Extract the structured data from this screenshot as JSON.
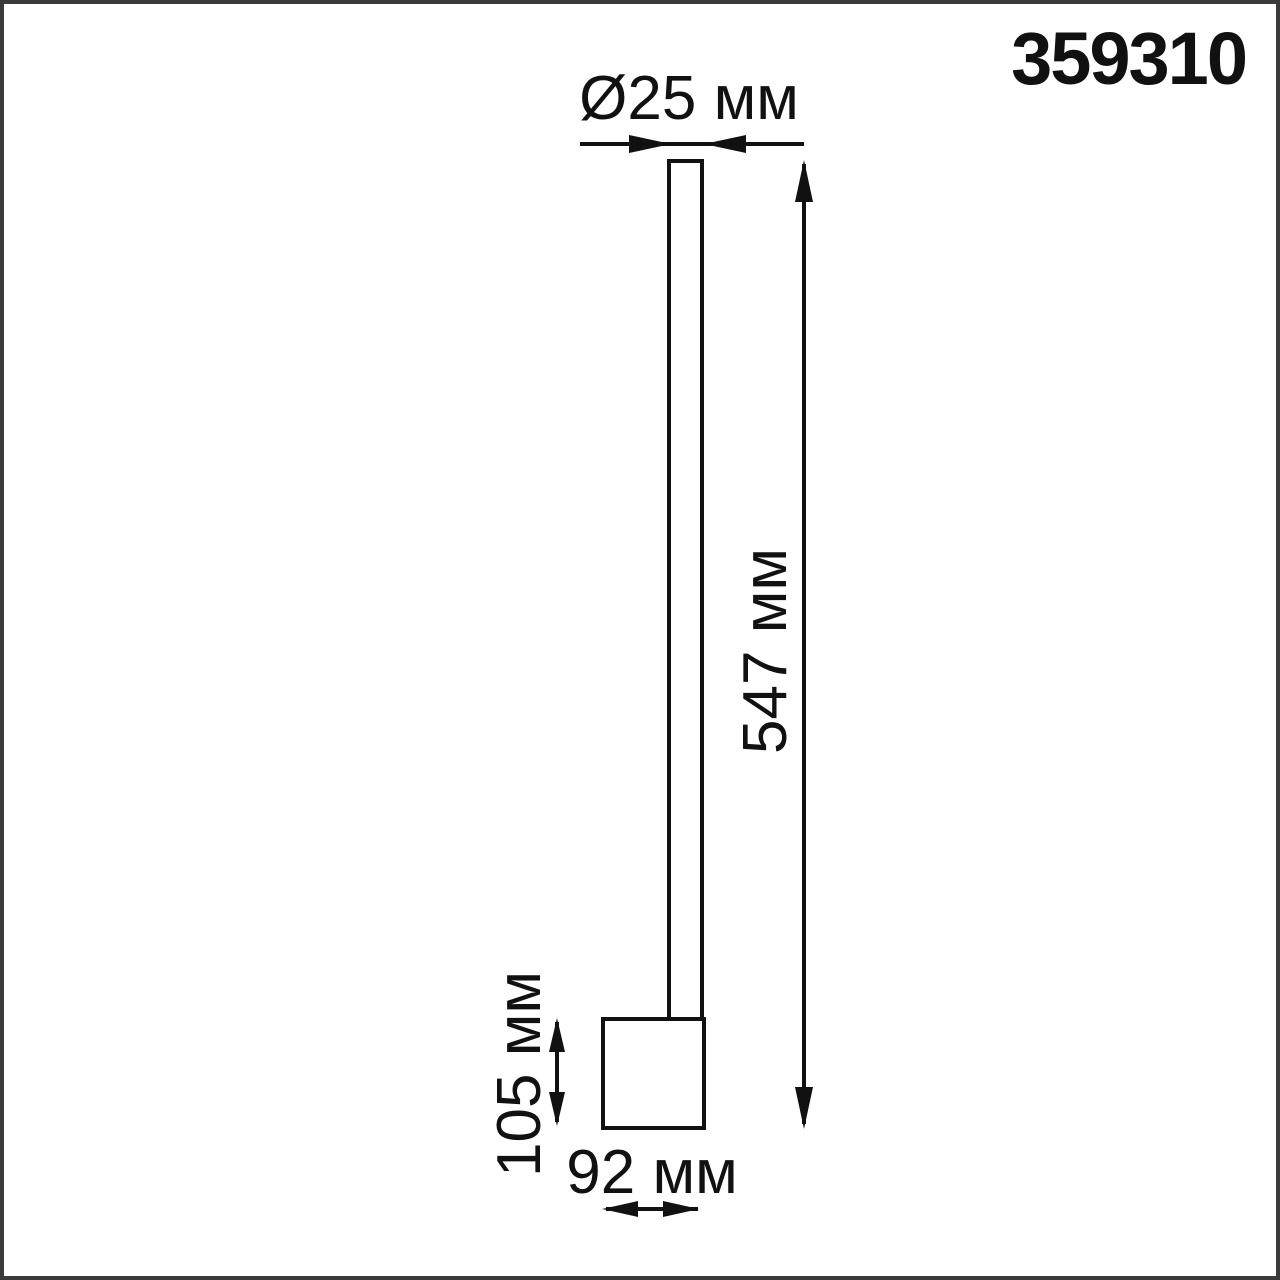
{
  "drawing": {
    "product_code": "359310",
    "type_note": "dimension-diagram-of-wall-lamp",
    "dimensions": {
      "diameter": "Ø25 мм",
      "height": "547 мм",
      "base_height": "105 мм",
      "base_width": "92 мм"
    },
    "colors": {
      "ink": "#111111",
      "border": "#3a3a3a",
      "background": "#ffffff"
    }
  }
}
